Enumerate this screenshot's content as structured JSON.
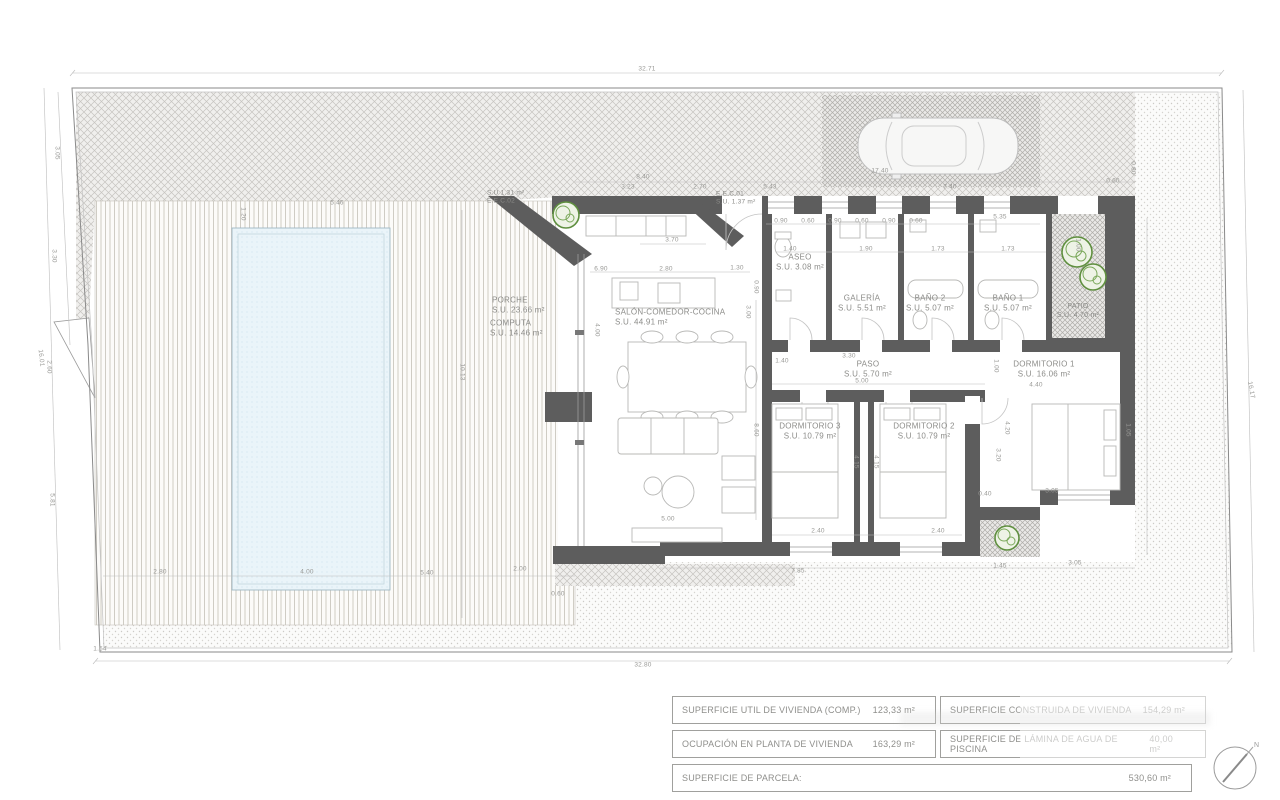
{
  "summary": {
    "rows": [
      {
        "label": "SUPERFICIE UTIL  DE VIVIENDA (COMP.)",
        "value": "123,33  m²"
      },
      {
        "label": "SUPERFICIE CONSTRUIDA DE VIVIENDA",
        "value": "154,29  m²"
      },
      {
        "label": "OCUPACIÓN EN PLANTA DE VIVIENDA",
        "value": "163,29 m²"
      },
      {
        "label": "SUPERFICIE DE LÁMINA DE AGUA DE PISCINA",
        "value": "40,00  m²"
      },
      {
        "label": "SUPERFICIE DE PARCELA:",
        "value": "530,60 m²"
      }
    ]
  },
  "compass": {
    "north": "N"
  },
  "plan": {
    "rooms": [
      {
        "id": "porche",
        "name": "PORCHE",
        "area": "S.U. 23.66 m²",
        "x": 492,
        "y": 306,
        "align": "left"
      },
      {
        "id": "computa",
        "name": "COMPUTA",
        "area": "S.U. 14.46 m²",
        "x": 490,
        "y": 329,
        "align": "left"
      },
      {
        "id": "salon",
        "name": "SALÓN-COMEDOR-COCINA",
        "area": "S.U. 44.91 m²",
        "x": 615,
        "y": 318,
        "align": "left"
      },
      {
        "id": "aseo",
        "name": "ASEO",
        "area": "S.U. 3.08 m²",
        "x": 800,
        "y": 263
      },
      {
        "id": "galeria",
        "name": "GALERÍA",
        "area": "S.U. 5.51 m²",
        "x": 862,
        "y": 304
      },
      {
        "id": "bano2",
        "name": "BAÑO 2",
        "area": "S.U. 5.07 m²",
        "x": 930,
        "y": 304
      },
      {
        "id": "bano1",
        "name": "BAÑO 1",
        "area": "S.U. 5.07 m²",
        "x": 1008,
        "y": 304
      },
      {
        "id": "patio",
        "name": "PATIO",
        "area": "S.U. 4.70 m²",
        "x": 1078,
        "y": 311,
        "size": 7
      },
      {
        "id": "paso",
        "name": "PASO",
        "area": "S.U. 5.70 m²",
        "x": 868,
        "y": 370
      },
      {
        "id": "dormitorio1",
        "name": "DORMITORIO 1",
        "area": "S.U. 16.06 m²",
        "x": 1044,
        "y": 370
      },
      {
        "id": "dormitorio3",
        "name": "DORMITORIO 3",
        "area": "S.U. 10.79 m²",
        "x": 810,
        "y": 432
      },
      {
        "id": "dormitorio2",
        "name": "DORMITORIO 2",
        "area": "S.U. 10.79 m²",
        "x": 924,
        "y": 432
      },
      {
        "id": "eec01",
        "name": "E.E.C.01",
        "area": "S.U. 1.37 m²",
        "x": 716,
        "y": 199,
        "align": "left",
        "size": 6.5
      },
      {
        "id": "eec02",
        "name": "S.U 1.31 m²",
        "area": "E.E.C.02",
        "x": 487,
        "y": 198,
        "align": "left",
        "size": 6.5
      }
    ],
    "dim_labels": [
      {
        "t": "32.71",
        "x": 647,
        "y": 69,
        "r": 0
      },
      {
        "t": "32.80",
        "x": 643,
        "y": 665,
        "r": 0
      },
      {
        "t": "16.01",
        "x": 41,
        "y": 358,
        "r": 84
      },
      {
        "t": "16.17",
        "x": 1251,
        "y": 390,
        "r": 80
      },
      {
        "t": "1.54",
        "x": 100,
        "y": 649,
        "r": 0
      },
      {
        "t": "3.05",
        "x": 57,
        "y": 153,
        "r": 90
      },
      {
        "t": "3.30",
        "x": 54,
        "y": 256,
        "r": 90
      },
      {
        "t": "2.60",
        "x": 49,
        "y": 367,
        "r": 90
      },
      {
        "t": "5.81",
        "x": 52,
        "y": 500,
        "r": 90
      },
      {
        "t": "8.40",
        "x": 643,
        "y": 177,
        "r": 0
      },
      {
        "t": "17.40",
        "x": 880,
        "y": 171,
        "r": 0
      },
      {
        "t": "3.23",
        "x": 628,
        "y": 187,
        "r": 0
      },
      {
        "t": "2.70",
        "x": 700,
        "y": 187,
        "r": 0
      },
      {
        "t": "5.43",
        "x": 770,
        "y": 187,
        "r": 0
      },
      {
        "t": "7.40",
        "x": 950,
        "y": 187,
        "r": 0
      },
      {
        "t": "0.60",
        "x": 1113,
        "y": 181,
        "r": 0
      },
      {
        "t": "0.80",
        "x": 1133,
        "y": 168,
        "r": 90
      },
      {
        "t": "0.90",
        "x": 781,
        "y": 221,
        "r": 0
      },
      {
        "t": "0.60",
        "x": 808,
        "y": 221,
        "r": 0
      },
      {
        "t": "0.90",
        "x": 835,
        "y": 221,
        "r": 0
      },
      {
        "t": "0.60",
        "x": 862,
        "y": 221,
        "r": 0
      },
      {
        "t": "0.90",
        "x": 889,
        "y": 221,
        "r": 0
      },
      {
        "t": "0.60",
        "x": 916,
        "y": 221,
        "r": 0
      },
      {
        "t": "5.35",
        "x": 1000,
        "y": 217,
        "r": 0
      },
      {
        "t": "1.40",
        "x": 790,
        "y": 249,
        "r": 0
      },
      {
        "t": "1.90",
        "x": 866,
        "y": 249,
        "r": 0
      },
      {
        "t": "1.73",
        "x": 938,
        "y": 249,
        "r": 0
      },
      {
        "t": "1.73",
        "x": 1008,
        "y": 249,
        "r": 0
      },
      {
        "t": "1.00",
        "x": 1078,
        "y": 245,
        "r": 90
      },
      {
        "t": "3.70",
        "x": 672,
        "y": 240,
        "r": 0
      },
      {
        "t": "6.90",
        "x": 601,
        "y": 269,
        "r": 0
      },
      {
        "t": "2.80",
        "x": 666,
        "y": 269,
        "r": 0
      },
      {
        "t": "1.30",
        "x": 737,
        "y": 268,
        "r": 0
      },
      {
        "t": "0.90",
        "x": 756,
        "y": 287,
        "r": 90
      },
      {
        "t": "3.00",
        "x": 748,
        "y": 312,
        "r": 90
      },
      {
        "t": "4.00",
        "x": 597,
        "y": 330,
        "r": 90
      },
      {
        "t": "1.40",
        "x": 782,
        "y": 361,
        "r": 0
      },
      {
        "t": "3.30",
        "x": 849,
        "y": 356,
        "r": 0
      },
      {
        "t": "5.00",
        "x": 862,
        "y": 381,
        "r": 0
      },
      {
        "t": "1.00",
        "x": 996,
        "y": 366,
        "r": 90
      },
      {
        "t": "4.40",
        "x": 1036,
        "y": 385,
        "r": 0
      },
      {
        "t": "8.60",
        "x": 756,
        "y": 430,
        "r": 90
      },
      {
        "t": "4.15",
        "x": 856,
        "y": 462,
        "r": 90
      },
      {
        "t": "4.15",
        "x": 876,
        "y": 462,
        "r": 90
      },
      {
        "t": "4.20",
        "x": 1007,
        "y": 428,
        "r": 90
      },
      {
        "t": "3.20",
        "x": 998,
        "y": 455,
        "r": 90
      },
      {
        "t": "2.40",
        "x": 818,
        "y": 531,
        "r": 0
      },
      {
        "t": "2.40",
        "x": 938,
        "y": 531,
        "r": 0
      },
      {
        "t": "0.40",
        "x": 985,
        "y": 494,
        "r": 0
      },
      {
        "t": "3.05",
        "x": 1052,
        "y": 491,
        "r": 0
      },
      {
        "t": "5.00",
        "x": 668,
        "y": 519,
        "r": 0
      },
      {
        "t": "7.85",
        "x": 798,
        "y": 571,
        "r": 0
      },
      {
        "t": "1.45",
        "x": 1000,
        "y": 566,
        "r": 0
      },
      {
        "t": "3.05",
        "x": 1075,
        "y": 563,
        "r": 0
      },
      {
        "t": "2.80",
        "x": 160,
        "y": 572,
        "r": 0
      },
      {
        "t": "4.00",
        "x": 307,
        "y": 572,
        "r": 0
      },
      {
        "t": "5.40",
        "x": 427,
        "y": 573,
        "r": 0
      },
      {
        "t": "2.00",
        "x": 520,
        "y": 569,
        "r": 0
      },
      {
        "t": "0.60",
        "x": 558,
        "y": 594,
        "r": 0
      },
      {
        "t": "5.46",
        "x": 337,
        "y": 203,
        "r": 0
      },
      {
        "t": "1.20",
        "x": 243,
        "y": 214,
        "r": 90
      },
      {
        "t": "10.13",
        "x": 462,
        "y": 372,
        "r": 90
      },
      {
        "t": "1.05",
        "x": 1128,
        "y": 430,
        "r": 90
      }
    ]
  }
}
